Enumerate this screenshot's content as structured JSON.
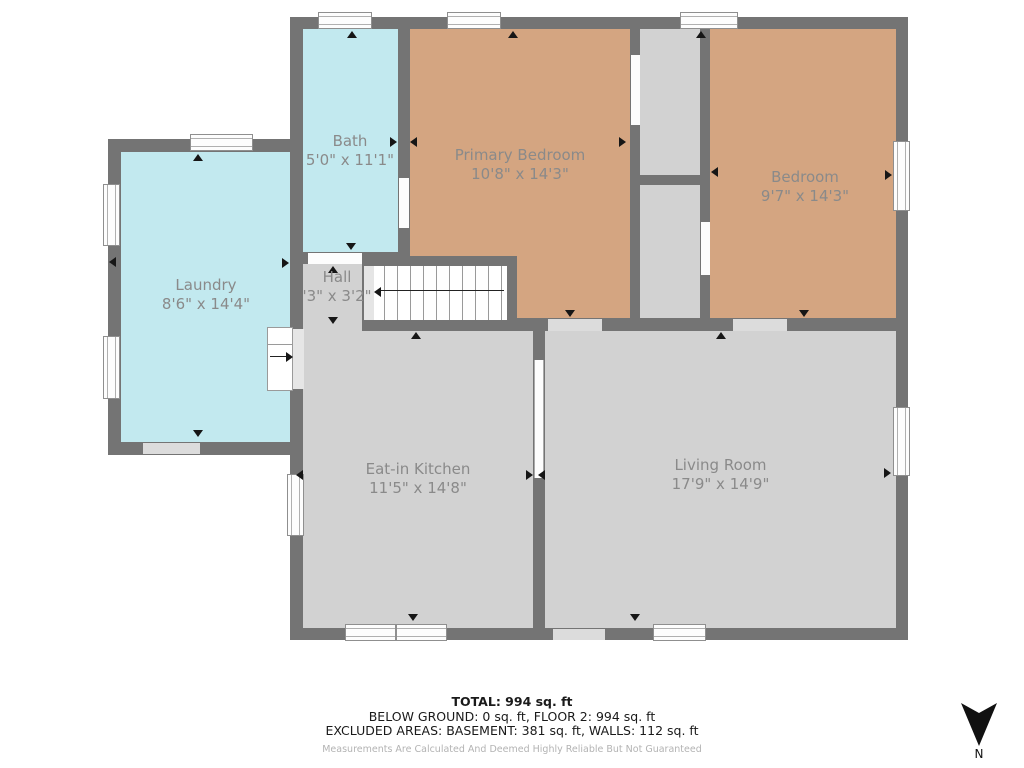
{
  "rooms": {
    "bath": {
      "label": "Bath",
      "dims": "5'0\" x 11'1\"",
      "color": "#c2e9ef"
    },
    "primary": {
      "label": "Primary Bedroom",
      "dims": "10'8\" x 14'3\"",
      "color": "#d4a581"
    },
    "bedroom": {
      "label": "Bedroom",
      "dims": "9'7\" x 14'3\"",
      "color": "#d4a581"
    },
    "laundry": {
      "label": "Laundry",
      "dims": "8'6\" x 14'4\"",
      "color": "#c2e9ef"
    },
    "hall": {
      "label": "Hall",
      "dims": "'3\" x 3'2\"",
      "color": "#d2d2d2"
    },
    "kitchen": {
      "label": "Eat-in Kitchen",
      "dims": "11'5\" x 14'8\"",
      "color": "#d2d2d2"
    },
    "living": {
      "label": "Living Room",
      "dims": "17'9\" x 14'9\"",
      "color": "#d2d2d2"
    }
  },
  "summary": {
    "total": "TOTAL: 994 sq. ft",
    "floors": "BELOW GROUND: 0 sq. ft, FLOOR 2: 994 sq. ft",
    "excluded": "EXCLUDED AREAS: BASEMENT: 381 sq. ft, WALLS: 112 sq. ft",
    "disclaimer": "Measurements Are Calculated And Deemed Highly Reliable But Not Guaranteed"
  },
  "compass": {
    "label": "N",
    "direction": "down"
  },
  "colors": {
    "wall": "#747474",
    "room_gray": "#d2d2d2",
    "room_tan": "#d4a581",
    "room_cyan": "#c2e9ef",
    "door_gap": "#dcdcdc"
  }
}
